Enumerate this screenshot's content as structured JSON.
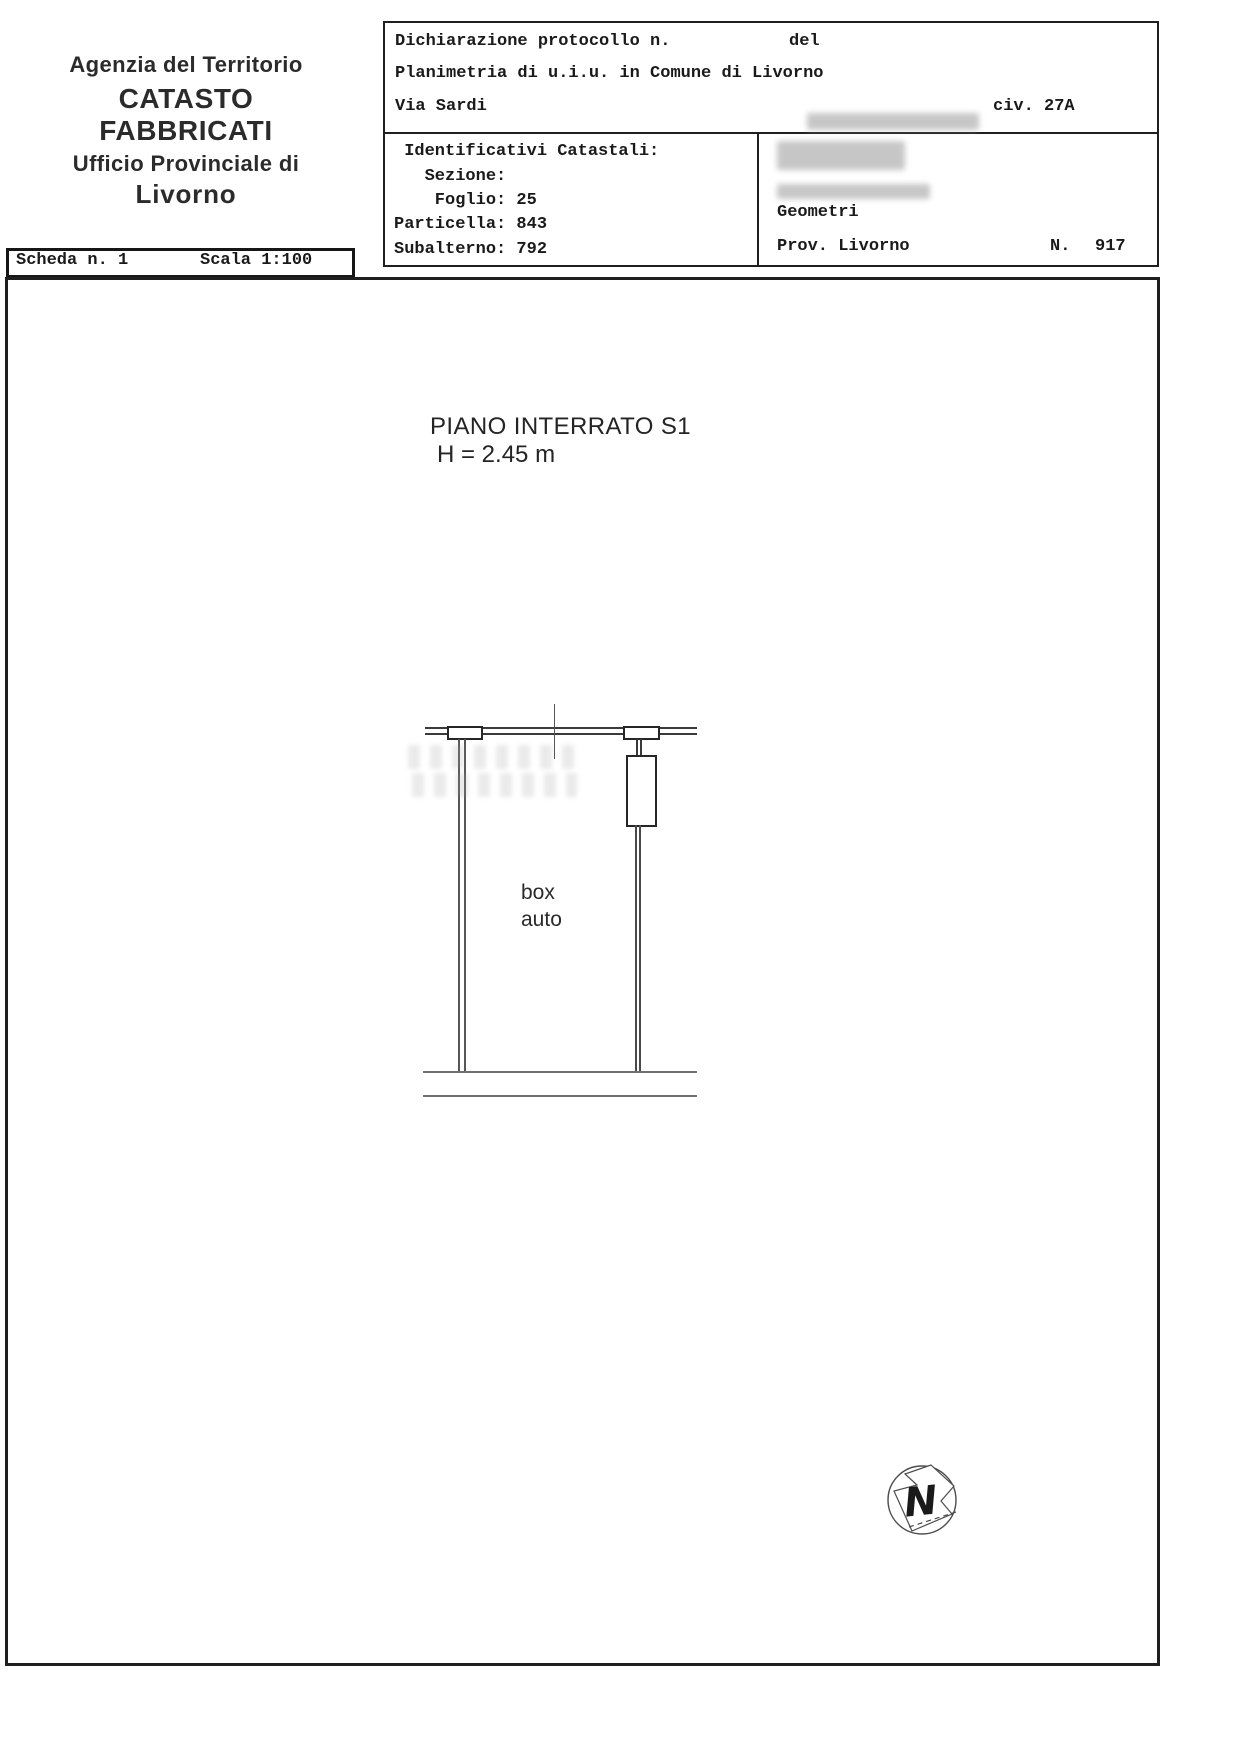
{
  "letterhead": {
    "line1": "Agenzia del Territorio",
    "line2": "CATASTO FABBRICATI",
    "line3": "Ufficio Provinciale di",
    "line4": "Livorno"
  },
  "header_table": {
    "declaration_label": "Dichiarazione protocollo n.",
    "declaration_del_label": "del",
    "planimetria_line": "Planimetria di u.i.u. in Comune di Livorno",
    "street": "Via Sardi",
    "civic": "civ. 27A",
    "identifiers": {
      "title": " Identificativi Catastali:",
      "sezione": "   Sezione:",
      "foglio": "    Foglio: 25",
      "particella": "Particella: 843",
      "subalterno": "Subalterno: 792"
    },
    "professional": {
      "role": "Geometri",
      "province": "Prov. Livorno",
      "number_label": "N.",
      "number_value": "917"
    }
  },
  "scheda_bar": {
    "scheda": "Scheda n. 1",
    "scala": "Scala 1:100"
  },
  "plan": {
    "floor_title": "PIANO INTERRATO S1",
    "floor_height": "H = 2.45 m",
    "room_label_line1": "box",
    "room_label_line2": "auto",
    "north_label": "N"
  },
  "colors": {
    "line_dark": "#1f1f1f",
    "line_gray": "#6f6f6f",
    "redaction_gray": "#b9b9b9"
  }
}
